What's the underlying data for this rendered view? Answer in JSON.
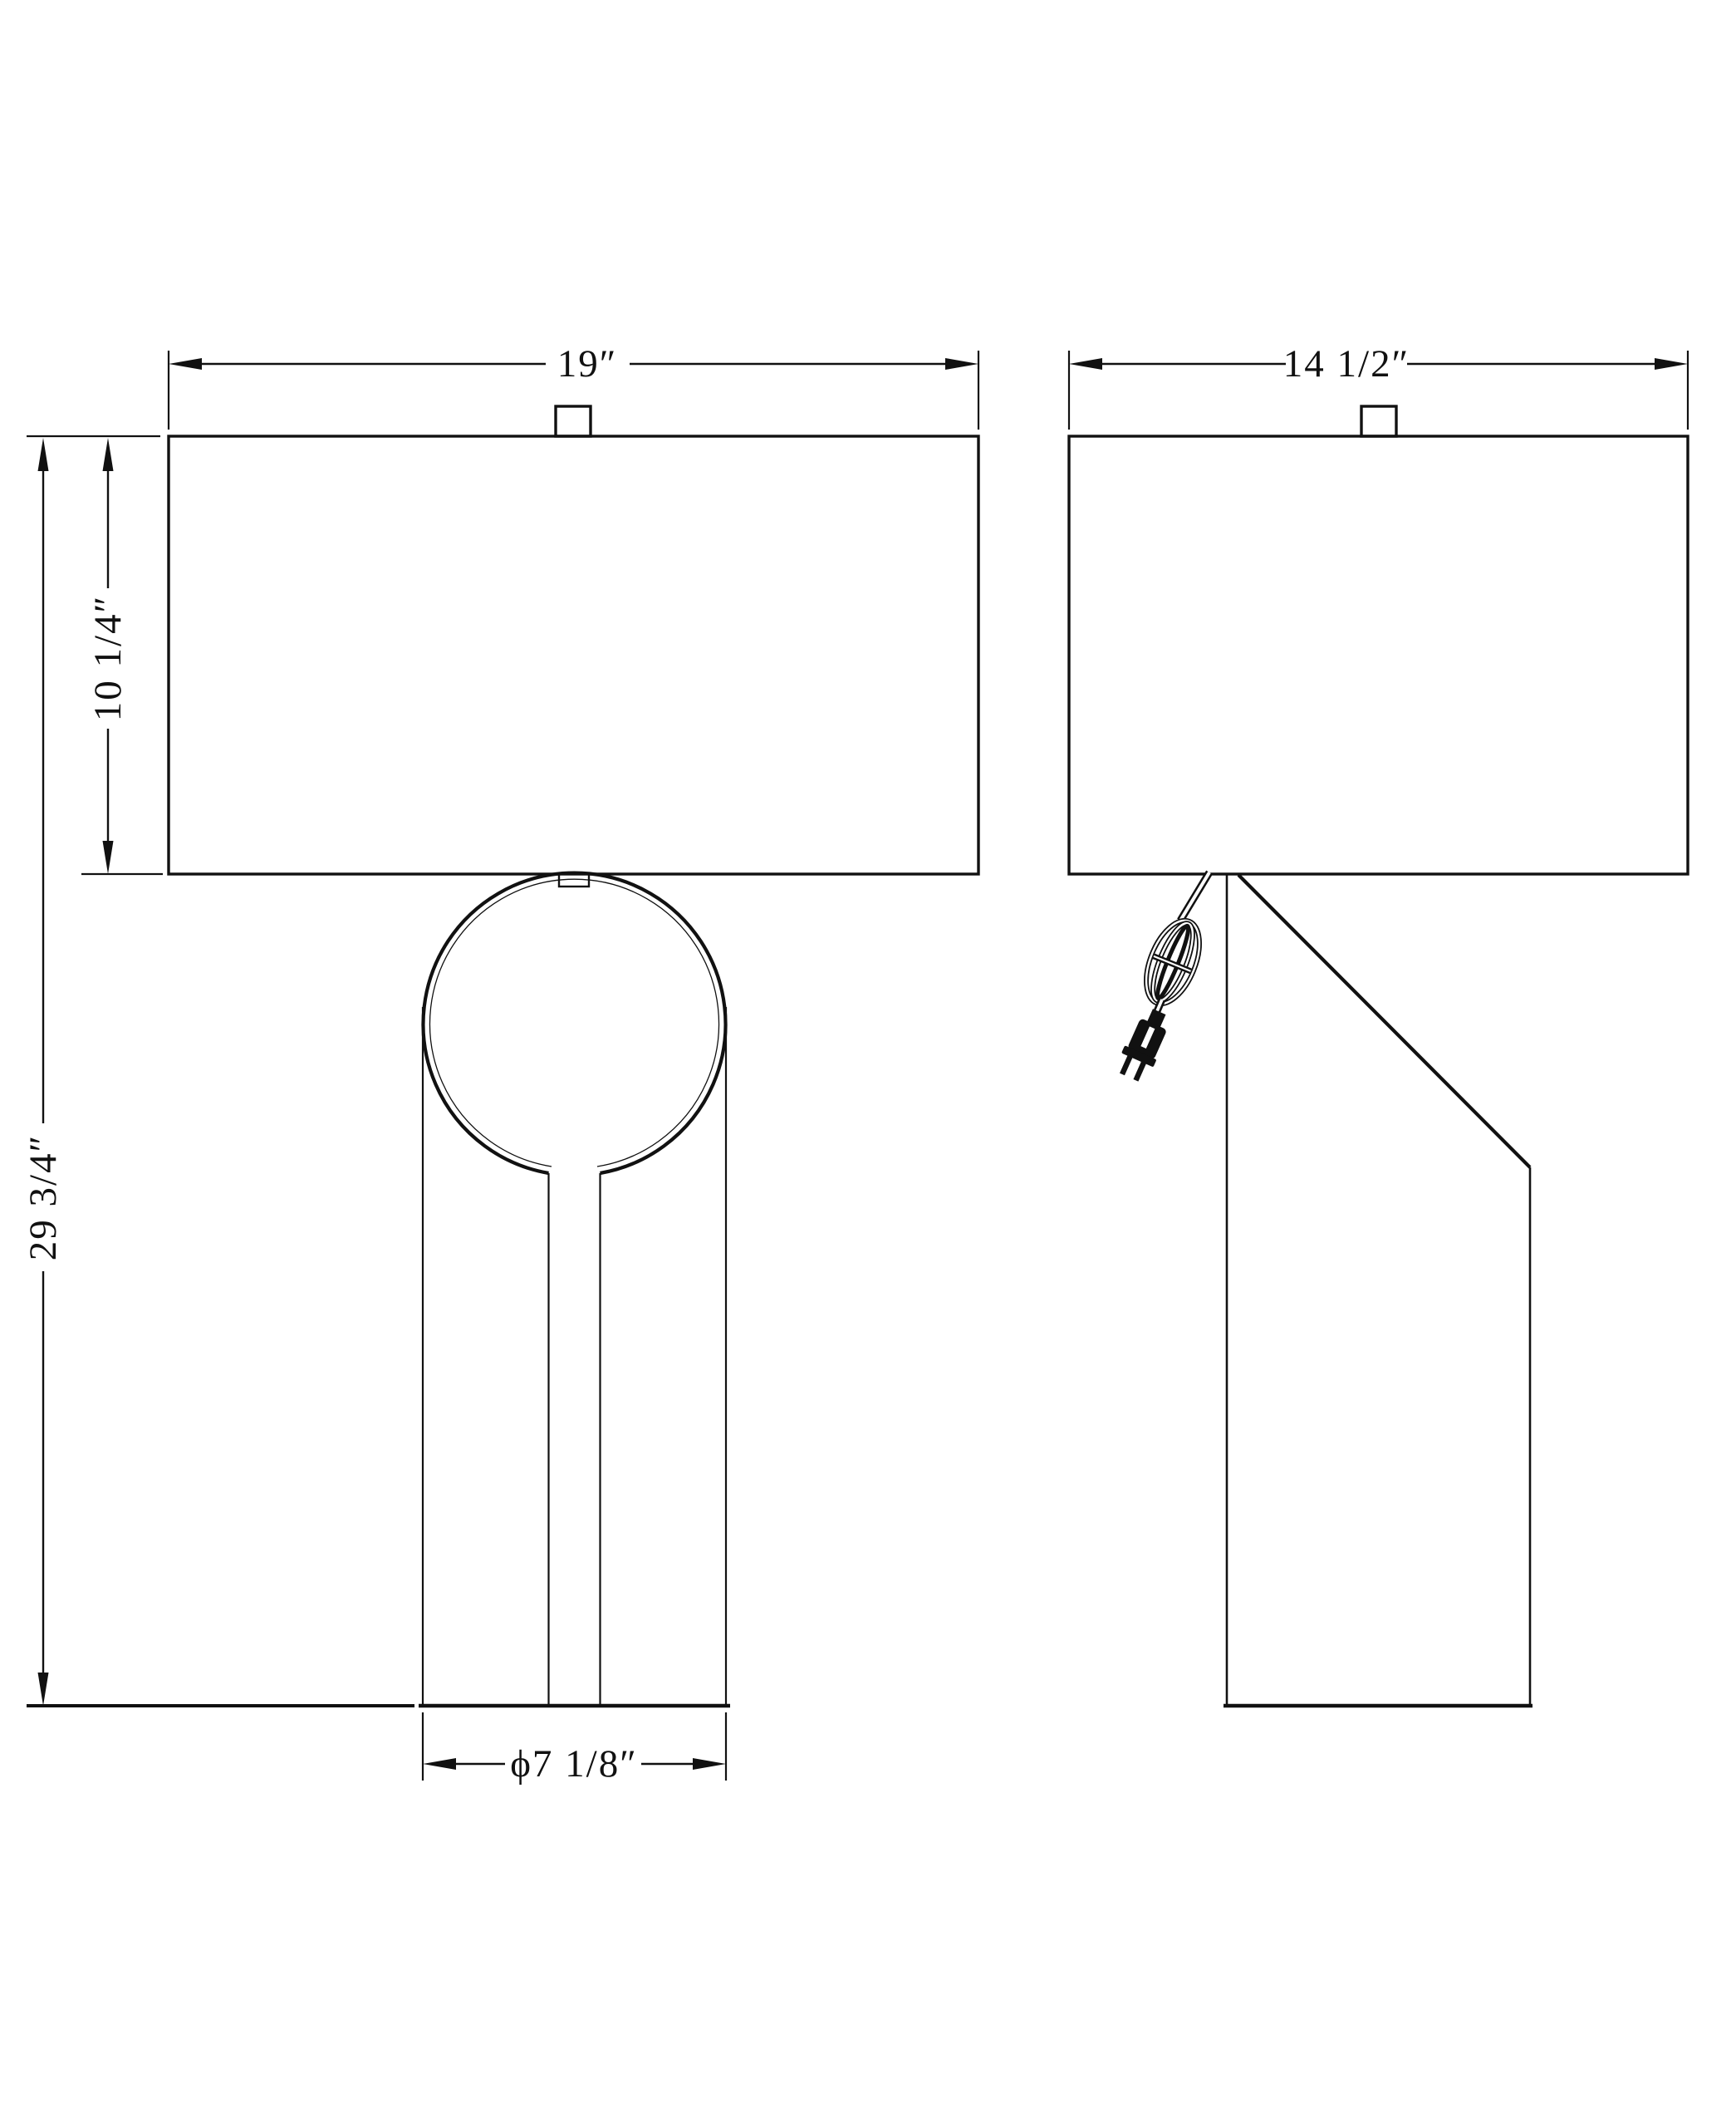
{
  "sheet": {
    "background": "#ffffff",
    "ink_color": "#111111",
    "subject": "table-lamp technical dimension drawing, front and side orthographic views"
  },
  "views": {
    "front": {
      "name": "front-view"
    },
    "side": {
      "name": "side-view"
    }
  },
  "dims": {
    "front_shade_width": "19″",
    "side_shade_width": "14 1/2″",
    "shade_height": "10 1/4″",
    "overall_height": "29 3/4″",
    "base_diameter": "ϕ7 1/8″"
  }
}
